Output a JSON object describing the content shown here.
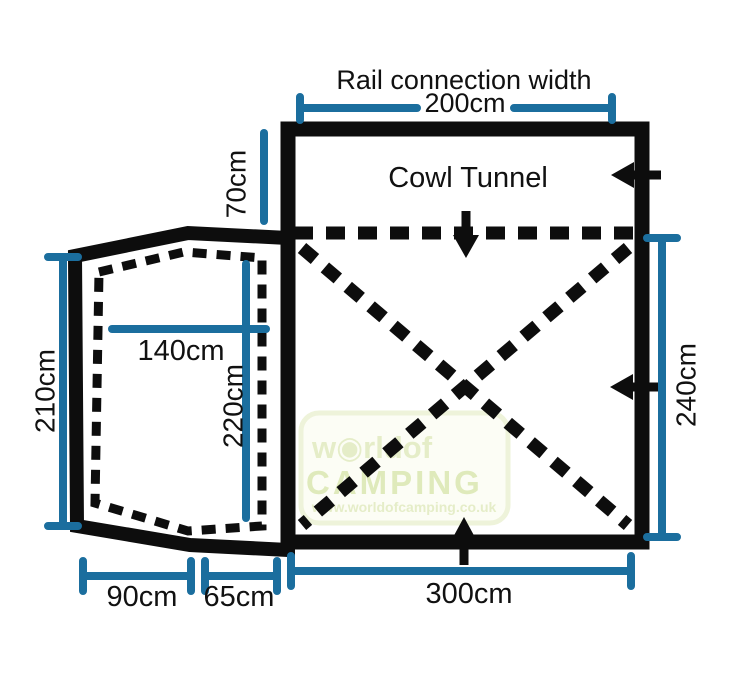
{
  "figure": {
    "description": "Caravan awning floor plan with dimensions"
  },
  "colors": {
    "outline": "#0d0d0d",
    "text": "#111111",
    "dimension": "#1b6e9e",
    "watermark_fill": "#fcfdf4",
    "watermark_border": "#edf2d6",
    "watermark_text": "#e3ecc3",
    "watermark_text_strong": "#dce8b4"
  },
  "labels": {
    "rail_connection_title": "Rail connection width",
    "rail_connection_width": "200cm",
    "cowl_tunnel": "Cowl Tunnel",
    "tunnel_length": "70cm",
    "annexe_side_height": "210cm",
    "annexe_inner_width": "140cm",
    "annexe_inner_length": "220cm",
    "main_side_length": "240cm",
    "annexe_base_width": "90cm",
    "connector_width": "65cm",
    "main_base_width": "300cm"
  },
  "watermark": {
    "brand_top": "w◉rldof",
    "brand_main": "CAMPING",
    "brand_url": "www.worldofcamping.co.uk"
  }
}
